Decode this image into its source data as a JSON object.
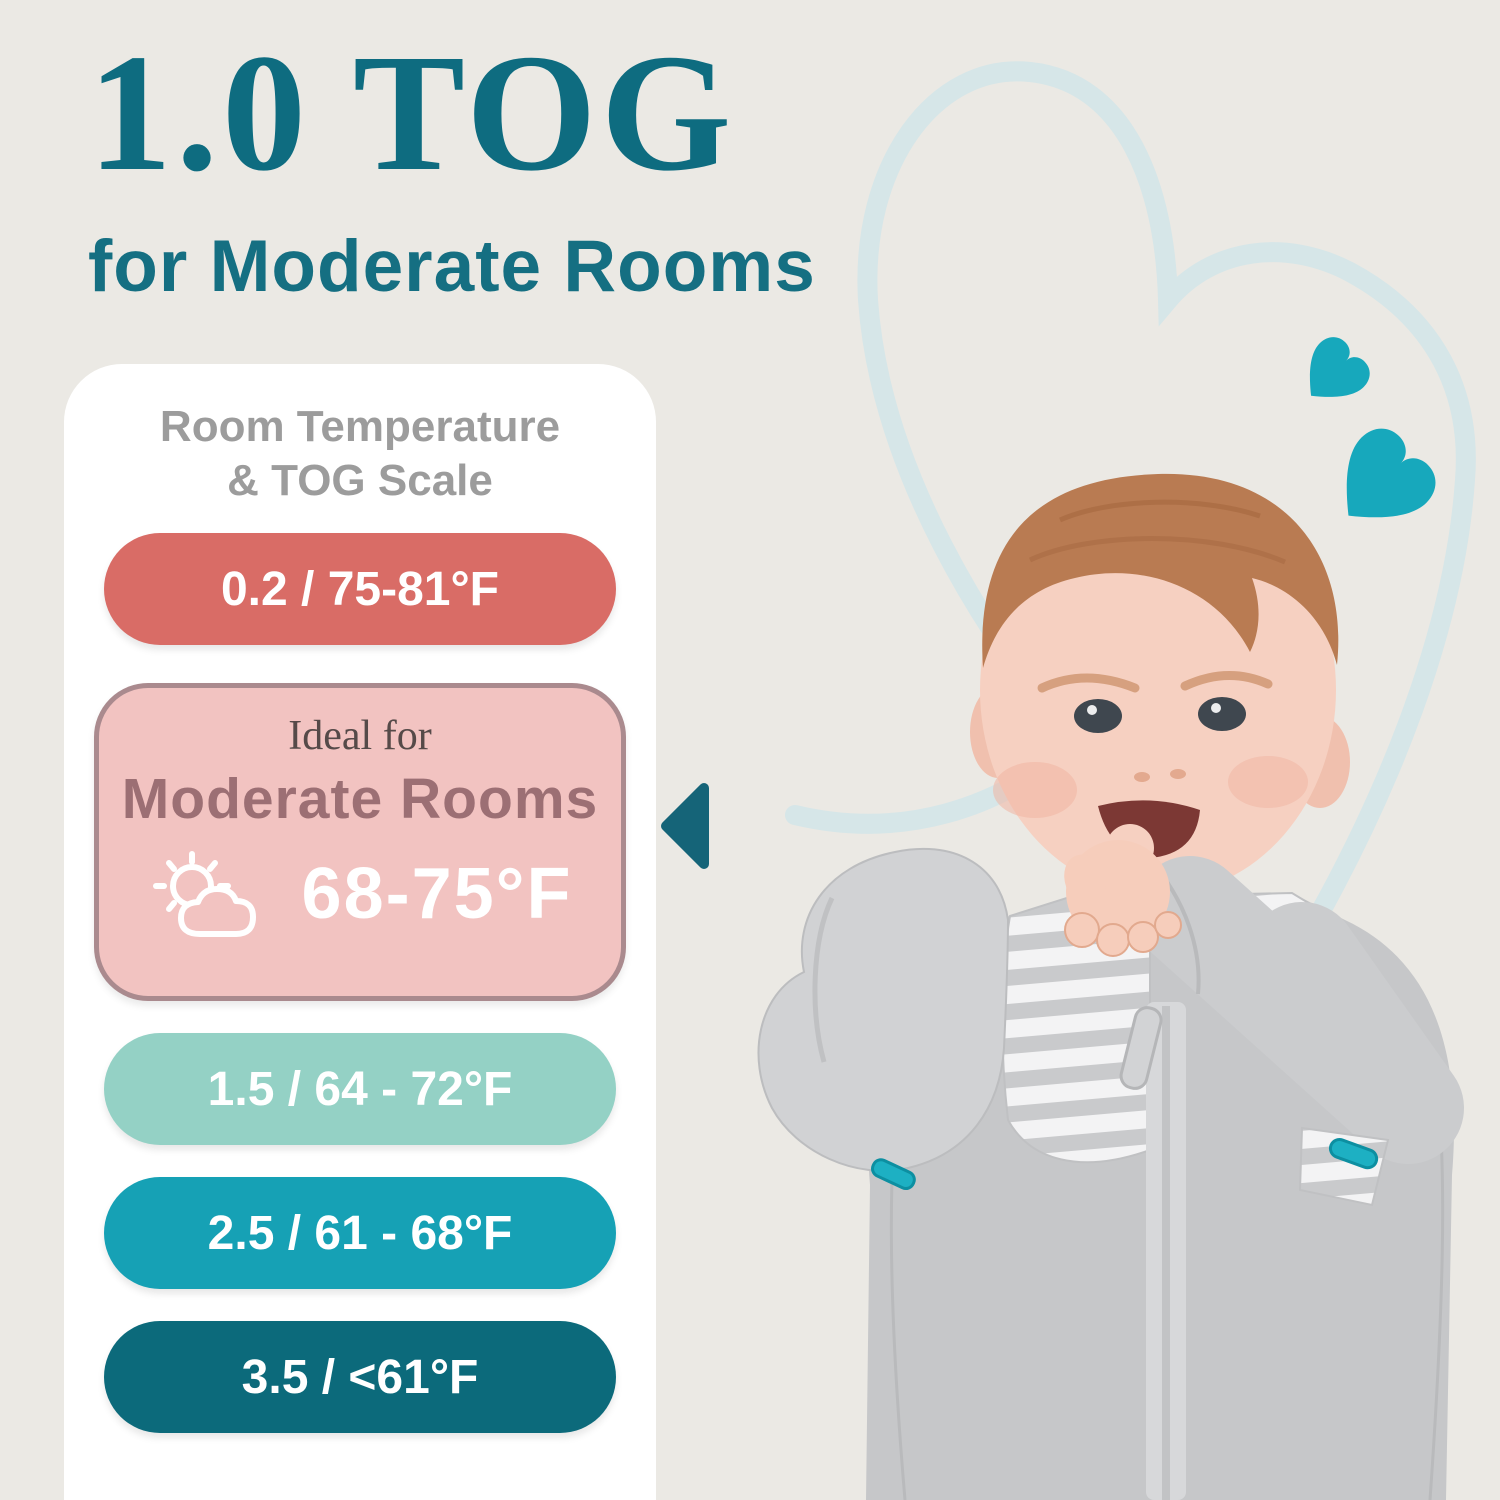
{
  "canvas": {
    "background": "#ebe9e4",
    "width": 1500,
    "height": 1500
  },
  "header": {
    "title": "1.0 TOG",
    "subtitle": "for Moderate Rooms",
    "color": "#0e6c80"
  },
  "tog_card": {
    "background": "#ffffff",
    "heading_line1": "Room Temperature",
    "heading_line2": "& TOG Scale",
    "heading_color": "#9c9c9c",
    "pointer_color": "#156478",
    "scale": [
      {
        "tog": "0.2",
        "label": "0.2 / 75-81°F",
        "bg": "#d96c66",
        "text_color": "#ffffff",
        "selected": false
      },
      {
        "tog": "1.0",
        "label_top": "Ideal for",
        "label_main": "Moderate Rooms",
        "temp": "68-75°F",
        "bg": "#f2c3c1",
        "border_color": "#aa8a8e",
        "label_top_color": "#564a49",
        "label_main_color": "#9c6f74",
        "temp_color": "#ffffff",
        "icon": "sun-behind-cloud-icon",
        "selected": true
      },
      {
        "tog": "1.5",
        "label": "1.5 / 64 - 72°F",
        "bg": "#94d1c5",
        "text_color": "#ffffff",
        "selected": false
      },
      {
        "tog": "2.5",
        "label": "2.5 / 61 - 68°F",
        "bg": "#16a1b5",
        "text_color": "#ffffff",
        "selected": false
      },
      {
        "tog": "3.5",
        "label": "3.5 / <61°F",
        "bg": "#0c6a7b",
        "text_color": "#ffffff",
        "selected": false
      }
    ]
  },
  "decor": {
    "heart_outline_color": "#d6e6e8",
    "hearts_fill": "#17a8bc"
  },
  "baby_photo": {
    "alt": "Smiling baby with fist in mouth wearing a gray swaddle sleep sack with wing-shaped arm pouch, striped chest panel, center zipper and teal zipper pulls",
    "swaddle_color": "#c6c7c9",
    "wing_color": "#d1d2d4",
    "skin_color": "#f6d0c1",
    "hair_color": "#b97b52"
  }
}
